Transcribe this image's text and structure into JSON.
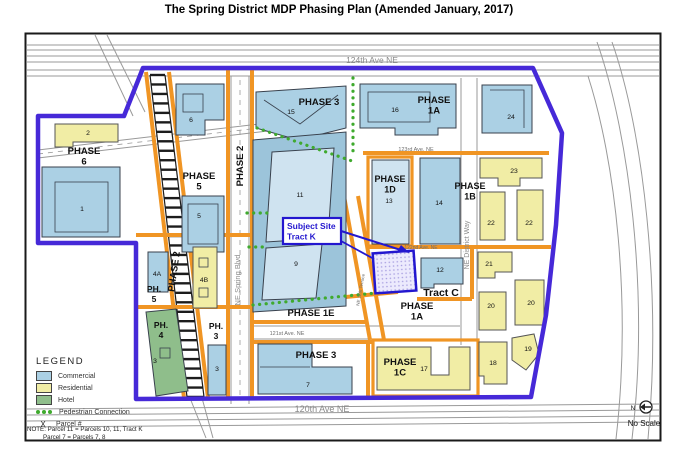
{
  "title": "The Spring District MDP Phasing Plan (Amended January, 2017)",
  "colors": {
    "commercial": "#abd0e4",
    "commercial_light": "#cfe3f0",
    "commercial_mid": "#9cc4da",
    "residential": "#f1eda5",
    "hotel": "#8fbe8b",
    "boundary_purple": "#4629d8",
    "street_orange": "#f09524",
    "pedestrian_green": "#3faa2e",
    "callout_blue": "#2418cf",
    "road_gray": "#999999"
  },
  "map": {
    "labels": [
      {
        "id": "street-124th-ave-ne",
        "x": 372,
        "y": 63,
        "size": 8.5,
        "color": "#8a8a8a",
        "lines": [
          "124th Ave NE"
        ]
      },
      {
        "id": "street-120th-ave-ne",
        "x": 322,
        "y": 412,
        "size": 9,
        "color": "#8a8a8a",
        "lines": [
          "120th Ave NE"
        ]
      },
      {
        "id": "street-123rd-ave-ne",
        "x": 416,
        "y": 151,
        "size": 5.5,
        "color": "#6f6f6f",
        "lines": [
          "123rd Ave. NE"
        ]
      },
      {
        "id": "street-122nd-ave-ne",
        "x": 421,
        "y": 249,
        "size": 5,
        "color": "#6f6f6f",
        "lines": [
          "122nd Ave. NE"
        ]
      },
      {
        "id": "street-121st-ave-ne",
        "x": 287,
        "y": 335,
        "size": 5.5,
        "color": "#6f6f6f",
        "lines": [
          "121st Ave. NE"
        ]
      },
      {
        "id": "street-ne-spring-blvd",
        "x": 240,
        "y": 280,
        "rot": -90,
        "size": 7.5,
        "color": "#8a8a8a",
        "lines": [
          "NE Spring Blvd"
        ]
      },
      {
        "id": "street-ne-district-way",
        "x": 469,
        "y": 245,
        "rot": -90,
        "size": 7,
        "color": "#8a8a8a",
        "lines": [
          "NE District Way"
        ]
      },
      {
        "id": "street-ne-12th-terrace",
        "x": 362,
        "y": 290,
        "rot": -80,
        "size": 4.5,
        "color": "#6f6f6f",
        "lines": [
          "NE 12th Terrace"
        ]
      },
      {
        "id": "phase-6",
        "x": 84,
        "y": 154,
        "bold": true,
        "lines": [
          "PHASE",
          "6"
        ]
      },
      {
        "id": "phase-5",
        "x": 199,
        "y": 179,
        "bold": true,
        "lines": [
          "PHASE",
          "5"
        ]
      },
      {
        "id": "phase-2-street",
        "x": 243,
        "y": 166,
        "rot": -90,
        "bold": true,
        "lines": [
          "PHASE 2"
        ]
      },
      {
        "id": "phase-2-rail",
        "x": 177,
        "y": 272,
        "rot": -82,
        "bold": true,
        "lines": [
          "PHASE 2"
        ]
      },
      {
        "id": "phase-3-top",
        "x": 319,
        "y": 105,
        "bold": true,
        "lines": [
          "PHASE 3"
        ]
      },
      {
        "id": "phase-1a-top",
        "x": 434,
        "y": 103,
        "bold": true,
        "lines": [
          "PHASE",
          "1A"
        ]
      },
      {
        "id": "phase-1d",
        "x": 390,
        "y": 182,
        "size": 9,
        "bold": true,
        "lines": [
          "PHASE",
          "1D"
        ]
      },
      {
        "id": "phase-1b",
        "x": 470,
        "y": 189,
        "size": 9,
        "bold": true,
        "lines": [
          "PHASE",
          "1B"
        ]
      },
      {
        "id": "phase-1e",
        "x": 311,
        "y": 316,
        "bold": true,
        "lines": [
          "PHASE 1E"
        ]
      },
      {
        "id": "phase-1a-bottom",
        "x": 417,
        "y": 309,
        "bold": true,
        "lines": [
          "PHASE",
          "1A"
        ]
      },
      {
        "id": "phase-3-bottom",
        "x": 316,
        "y": 358,
        "bold": true,
        "lines": [
          "PHASE 3"
        ]
      },
      {
        "id": "phase-1c",
        "x": 400,
        "y": 365,
        "bold": true,
        "lines": [
          "PHASE",
          "1C"
        ]
      },
      {
        "id": "ph-5",
        "x": 154,
        "y": 292,
        "size": 8.5,
        "lh": 10,
        "bold": true,
        "lines": [
          "PH.",
          "5"
        ]
      },
      {
        "id": "ph-4",
        "x": 161,
        "y": 328,
        "size": 8.5,
        "lh": 10,
        "bold": true,
        "lines": [
          "PH.",
          "4"
        ]
      },
      {
        "id": "ph-3",
        "x": 216,
        "y": 329,
        "size": 8.5,
        "lh": 10,
        "bold": true,
        "lines": [
          "PH.",
          "3"
        ]
      },
      {
        "id": "tract-c",
        "x": 441,
        "y": 296,
        "size": 10.5,
        "bold": true,
        "lines": [
          "Tract C"
        ]
      },
      {
        "id": "subject-site-callout",
        "x": 287,
        "y": 229,
        "size": 8.5,
        "bold": true,
        "anchor": "start",
        "color": "#2418cf",
        "lines": [
          "Subject Site",
          "Tract K"
        ]
      },
      {
        "id": "north-n",
        "x": 633,
        "y": 410,
        "size": 6.5,
        "lines": [
          "N"
        ]
      },
      {
        "id": "no-scale",
        "x": 644,
        "y": 426,
        "size": 8,
        "lines": [
          "No Scale"
        ]
      }
    ],
    "parcel_numbers": [
      {
        "n": "1",
        "x": 82,
        "y": 211
      },
      {
        "n": "2",
        "x": 88,
        "y": 135
      },
      {
        "n": "3",
        "x": 155,
        "y": 363
      },
      {
        "n": "3",
        "x": 217,
        "y": 371
      },
      {
        "n": "4A",
        "x": 157,
        "y": 276
      },
      {
        "n": "4B",
        "x": 204,
        "y": 282
      },
      {
        "n": "5",
        "x": 199,
        "y": 218
      },
      {
        "n": "6",
        "x": 191,
        "y": 122
      },
      {
        "n": "7",
        "x": 308,
        "y": 387
      },
      {
        "n": "9",
        "x": 296,
        "y": 266
      },
      {
        "n": "11",
        "x": 300,
        "y": 197
      },
      {
        "n": "12",
        "x": 440,
        "y": 272
      },
      {
        "n": "13",
        "x": 389,
        "y": 203,
        "size": 6.5
      },
      {
        "n": "14",
        "x": 439,
        "y": 205
      },
      {
        "n": "15",
        "x": 291,
        "y": 114
      },
      {
        "n": "16",
        "x": 395,
        "y": 112
      },
      {
        "n": "17",
        "x": 424,
        "y": 371
      },
      {
        "n": "18",
        "x": 493,
        "y": 365
      },
      {
        "n": "19",
        "x": 528,
        "y": 351
      },
      {
        "n": "20",
        "x": 491,
        "y": 308
      },
      {
        "n": "20",
        "x": 531,
        "y": 305
      },
      {
        "n": "21",
        "x": 489,
        "y": 266
      },
      {
        "n": "22",
        "x": 491,
        "y": 225
      },
      {
        "n": "22",
        "x": 529,
        "y": 225
      },
      {
        "n": "23",
        "x": 514,
        "y": 173
      },
      {
        "n": "24",
        "x": 511,
        "y": 119
      }
    ]
  },
  "legend": {
    "title": "LEGEND",
    "items": [
      {
        "label": "Commercial",
        "type": "commercial"
      },
      {
        "label": "Residential",
        "type": "residential"
      },
      {
        "label": "Hotel",
        "type": "hotel"
      },
      {
        "label": "Pedestrian Connection",
        "type": "pedestrian"
      },
      {
        "label": "Parcel #",
        "type": "parcel",
        "symbol": "X"
      }
    ],
    "note_line1": "NOTE: Parcel 11 = Parcels 10, 11, Tract K",
    "note_line2": "Parcel 7 = Parcels 7, 8"
  }
}
